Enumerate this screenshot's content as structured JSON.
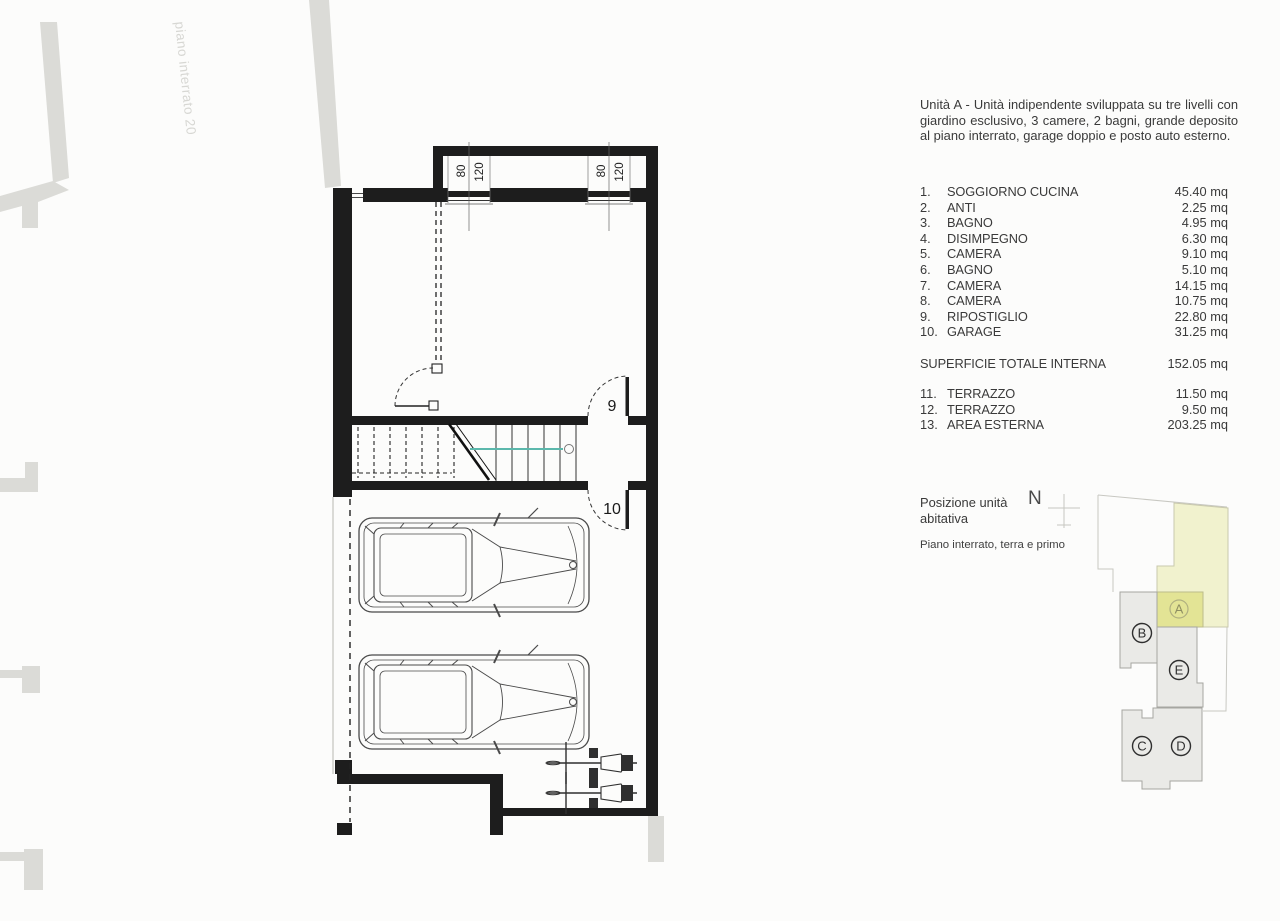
{
  "header": {
    "description": "Unità A - Unità indipendente sviluppata su tre livelli con giardino esclusivo, 3 camere, 2 bagni, grande deposito al piano interrato, garage doppio e posto auto esterno."
  },
  "rooms": [
    {
      "num": "1.",
      "name": "SOGGIORNO CUCINA",
      "area": "45.40 mq"
    },
    {
      "num": "2.",
      "name": "ANTI",
      "area": "2.25 mq"
    },
    {
      "num": "3.",
      "name": "BAGNO",
      "area": "4.95 mq"
    },
    {
      "num": "4.",
      "name": "DISIMPEGNO",
      "area": "6.30 mq"
    },
    {
      "num": "5.",
      "name": "CAMERA",
      "area": "9.10 mq"
    },
    {
      "num": "6.",
      "name": "BAGNO",
      "area": "5.10 mq"
    },
    {
      "num": "7.",
      "name": "CAMERA",
      "area": "14.15 mq"
    },
    {
      "num": "8.",
      "name": "CAMERA",
      "area": "10.75 mq"
    },
    {
      "num": "9.",
      "name": "RIPOSTIGLIO",
      "area": "22.80 mq"
    },
    {
      "num": "10.",
      "name": "GARAGE",
      "area": "31.25 mq"
    }
  ],
  "total": {
    "label": "SUPERFICIE TOTALE INTERNA",
    "area": "152.05 mq"
  },
  "externals": [
    {
      "num": "11.",
      "name": "TERRAZZO",
      "area": "11.50 mq"
    },
    {
      "num": "12.",
      "name": "TERRAZZO",
      "area": "9.50 mq"
    },
    {
      "num": "13.",
      "name": "AREA ESTERNA",
      "area": "203.25 mq"
    }
  ],
  "position": {
    "line1": "Posizione unità",
    "line2": "abitativa",
    "compass_n": "N",
    "floors": "Piano interrato, terra e primo"
  },
  "plan": {
    "watermark": "piano interrato 20",
    "room_labels": {
      "deposito": "9",
      "garage": "10"
    },
    "window_dims": {
      "width": "80",
      "height": "120"
    }
  },
  "minimap": {
    "units": [
      {
        "label": "A"
      },
      {
        "label": "B"
      },
      {
        "label": "C"
      },
      {
        "label": "D"
      },
      {
        "label": "E"
      }
    ],
    "colors": {
      "garden": "#f1f2ce",
      "unit_a": "#e3e495",
      "building": "#eaeae7",
      "walls": "#1d1d1d"
    }
  }
}
